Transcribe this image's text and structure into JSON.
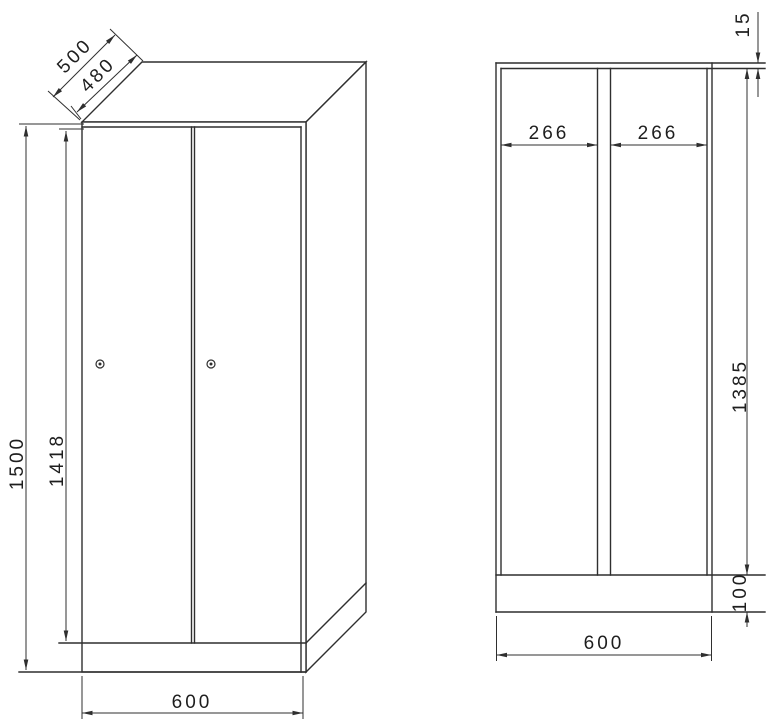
{
  "drawing": {
    "perspective_view": {
      "depth_total": "500",
      "depth_body": "480",
      "height_total": "1500",
      "height_door": "1418",
      "width_front": "600"
    },
    "front_view": {
      "compartment_left": "266",
      "compartment_right": "266",
      "top_panel_thickness": "15",
      "interior_height": "1385",
      "plinth_height": "100",
      "width": "600"
    }
  },
  "colors": {
    "line": "#2f2f2f",
    "text": "#1e1e1e",
    "background": "#ffffff"
  }
}
